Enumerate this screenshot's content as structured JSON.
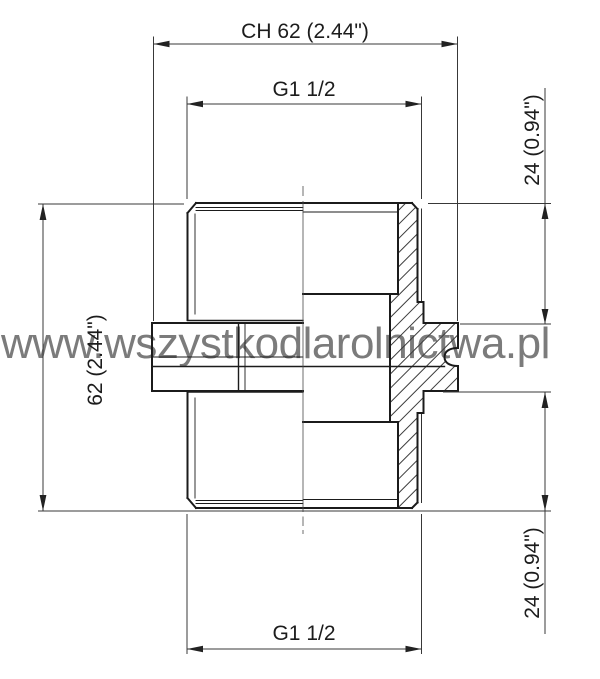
{
  "page": {
    "background": "#ffffff",
    "line_color": "#1b1b1b",
    "dimension_line_color": "#383838"
  },
  "watermark": {
    "text": "www.wszystkodlarolnictwa.pl",
    "color": "#7b7b7b"
  },
  "drawing": {
    "type": "technical-drawing",
    "subject": "hex-nipple-fitting-half-section",
    "dimensions": {
      "ch_width": "CH 62  (2.44\")",
      "thread_top": "G1 1/2",
      "thread_length_top": "24  (0.94\")",
      "height": "62  (2.44\")",
      "thread_length_bottom": "24  (0.94\")",
      "thread_bottom": "G1 1/2"
    }
  }
}
